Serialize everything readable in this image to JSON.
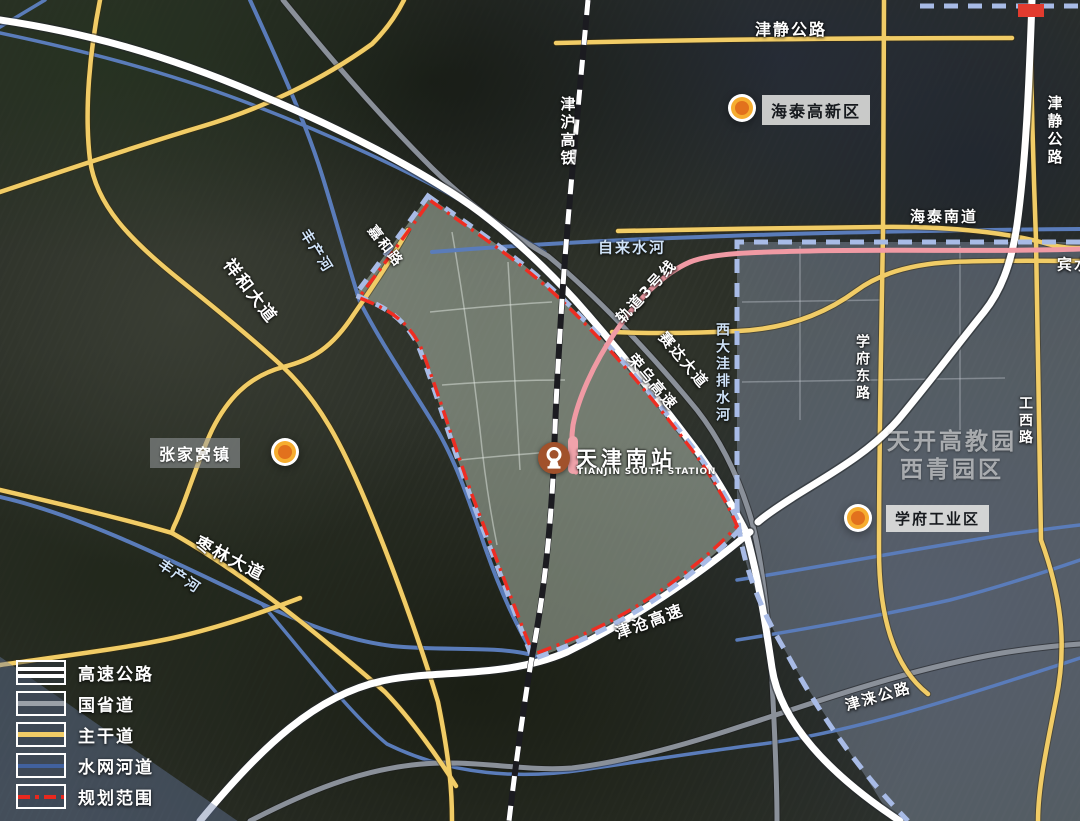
{
  "legend": {
    "items": [
      {
        "label": "高速公路",
        "type": "expressway"
      },
      {
        "label": "国省道",
        "type": "national-provincial-road"
      },
      {
        "label": "主干道",
        "type": "arterial-road"
      },
      {
        "label": "水网河道",
        "type": "waterway"
      },
      {
        "label": "规划范围",
        "type": "planning-boundary"
      }
    ]
  },
  "station": {
    "name": "天津南站",
    "name_en": "TIANJIN SOUTH STATION"
  },
  "poi_markers": [
    {
      "id": "haitai",
      "label": "海泰高新区"
    },
    {
      "id": "zhangjiawo",
      "label": "张家窝镇"
    },
    {
      "id": "xuefu",
      "label": "学府工业区"
    }
  ],
  "district_label": {
    "line1": "天开高教园",
    "line2": "西青园区"
  },
  "road_labels": {
    "jinjing_top": "津静公路",
    "jinjing_right": "津静公路",
    "haitai_south": "海泰南道",
    "jinhu_rail": "津沪高铁",
    "zilaishui_river": "自来水河",
    "metro3": "轨道3号线",
    "saida_avenue": "赛达大道",
    "rongwu_expwy": "荣乌高速",
    "xidawa_river": "西大洼排水河",
    "jiahe_road": "嘉和路",
    "xianghe_avenue": "祥和大道",
    "fengchan_river_n": "丰产河",
    "fengchan_river_s": "丰产河",
    "zaolin_avenue": "枣林大道",
    "jincang_expwy": "津沧高速",
    "jinlai_highway": "津涞公路",
    "xuefu_east_road": "学府东路",
    "gongxi_road": "工西路",
    "binshui": "宾水"
  },
  "colors": {
    "expressway": "#ffffff",
    "national_road": "#8a9099",
    "arterial": "#f1cc66",
    "waterway": "#5a7cba",
    "boundary_red": "#ee2d22",
    "boundary_blue_dash": "#a8bbe6",
    "metro_line": "#f09aa4",
    "railway_dark": "#1b1b20",
    "marker_core": "#e2711d",
    "marker_ring": "#f6ad2f",
    "station_icon_bg": "#a1512b",
    "planning_zone_fill": "rgba(213,226,210,0.42)",
    "east_district_fill": "rgba(170,185,215,0.33)"
  }
}
